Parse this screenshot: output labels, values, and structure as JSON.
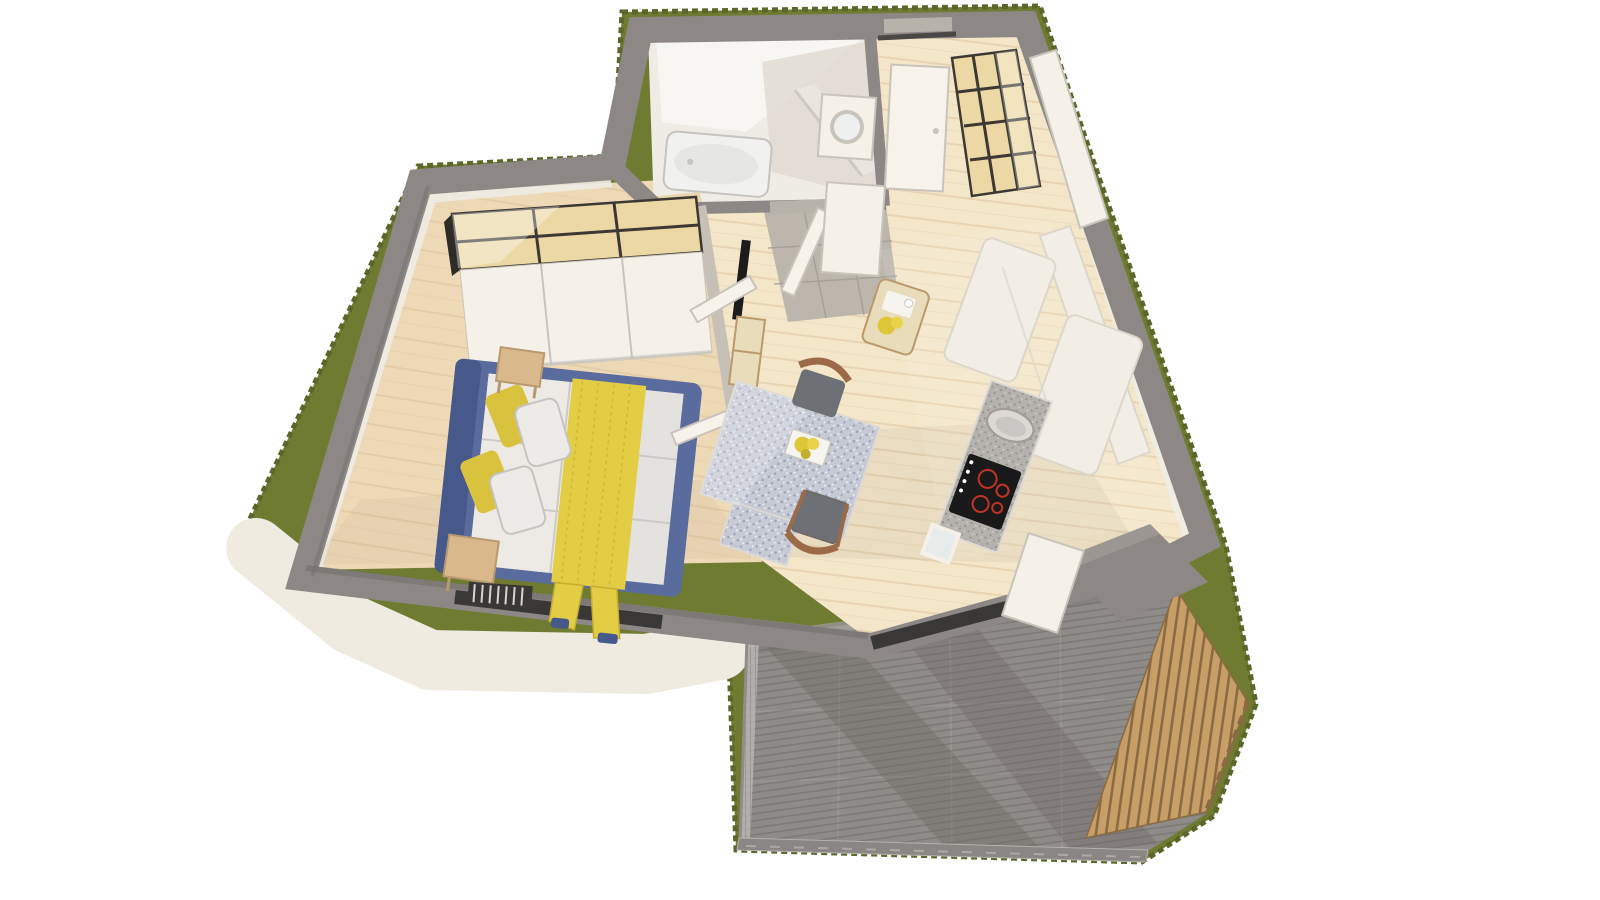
{
  "scene": {
    "type": "3d-floor-plan-render",
    "rooms": [
      "bedroom",
      "bathroom",
      "entry-hall",
      "living-room",
      "kitchen",
      "balcony"
    ],
    "objects": [
      "grass-border",
      "exterior-apron",
      "perimeter-walls",
      "wardrobe",
      "double-bed",
      "nightstand",
      "radiator",
      "bathtub",
      "vanity",
      "shower-glass",
      "entrance-door",
      "washing-machine",
      "hall-cabinet",
      "cube-shelf",
      "sofa",
      "coffee-table",
      "dining-table",
      "dining-chair",
      "tv",
      "tv-stand",
      "plant",
      "kitchen-counter",
      "sink",
      "cooktop",
      "fridge-cabinet",
      "balcony-railing",
      "balcony-louver-wall",
      "wood-threshold"
    ]
  },
  "colors": {
    "background": "#ffffff",
    "grass": "#6e7b31",
    "grass_edge": "#5a662a",
    "apron": "#f0ebe1",
    "wall": "#8d8885",
    "wall_dark": "#6f6b68",
    "wall_light": "#a6a19d",
    "wall_deep": "#4a4745",
    "glass_dark": "#3a3836",
    "interior_white": "#efece5",
    "interior_bright": "#f8f6f2",
    "interior_shade": "#e0dbd2",
    "wood_floor": "#eed9b7",
    "wood_floor_light": "#f3e6c9",
    "plank_line": "#dcc096",
    "hall_tile": "#b7b2aa",
    "tile_line": "#a19c94",
    "terrazzo_bg": "#c6cad4",
    "terrazzo_dot": "#98a0b8",
    "terrazzo_light": "#ffffff",
    "chair_wood": "#9c6a48",
    "chair_seat": "#6d7075",
    "coffee_table": "#e9dcba",
    "flower_yellow": "#ddc738",
    "flower_yellow2": "#e8d34a",
    "tray_white": "#f6f4ef",
    "sofa": "#f2eee6",
    "sofa_shadow": "#ddd7cb",
    "shelf_wood": "#ecd8a4",
    "shelf_frame": "#3d3833",
    "cabinet_white": "#f5f1e9",
    "door_white": "#f7f3eb",
    "door_edge": "#c9c4bb",
    "counter_granite": "#b5b1ad",
    "granite_dot": "#908d8a",
    "granite_light": "#dcd9d5",
    "sink_inner": "#c9c7c3",
    "cooktop": "#191919",
    "burner_red": "#c23326",
    "bed_frame": "#5a6b9d",
    "bed_frame_dark": "#47588a",
    "bedding": "#e4e2df",
    "bedding_shadow": "#c6c4c0",
    "pillow_white": "#edebe7",
    "pillow_yellow": "#d9c33e",
    "blanket_yellow": "#e3cd45",
    "blanket_shadow": "#c4ae2f",
    "side_table": "#d9b98c",
    "side_table_edge": "#b99a6e",
    "radiator": "#3a3836",
    "radiator_fin": "#d8d5d0",
    "tv_black": "#1c1c1c",
    "tv_panel": "#c6c0b7",
    "plant_green": "#5e7d3a",
    "plant_dark": "#46622c",
    "pot_white": "#eceae5",
    "threshold_wood": "#d9b98c",
    "balcony_tile": "#8f8b88",
    "balcony_shadow": "#6c6865",
    "balcony_light": "#a4a09c",
    "fine_stripe": "#57534f",
    "curb": "#8a8683",
    "curb_light": "#b5b1ad",
    "rail_glass": "#b9b7b4",
    "rail_line": "#8f8c89",
    "louver_wood": "#c79e66",
    "louver_gap": "#8a6a42",
    "bathtub": "#f1f1ef",
    "tub_inner": "#e6e6e3",
    "vanity_wood": "#e7d5ae",
    "shadow_soft": "#6b5f50",
    "sun_light": "#ffffff"
  }
}
